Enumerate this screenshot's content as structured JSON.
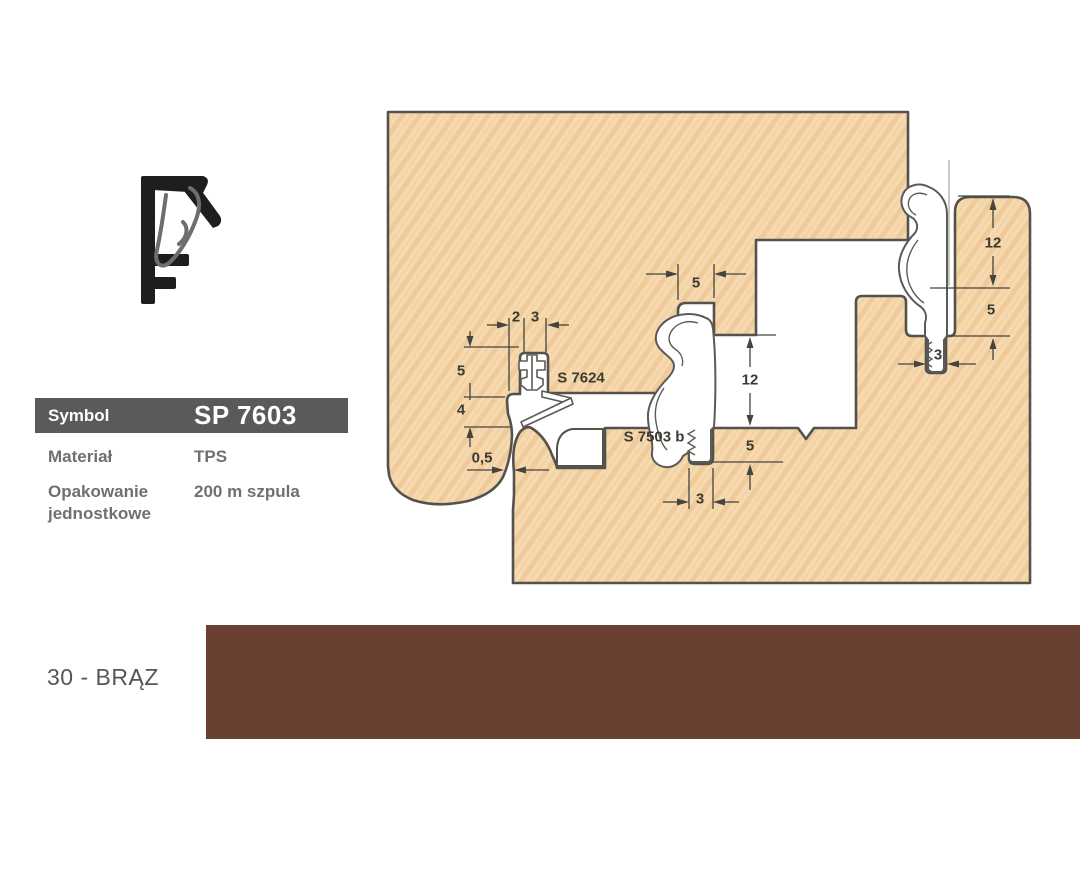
{
  "product": {
    "symbol_label": "Symbol",
    "symbol_value": "SP 7603",
    "material_label": "Materiał",
    "material_value": "TPS",
    "packaging_label_line1": "Opakowanie",
    "packaging_label_line2": "jednostkowe",
    "packaging_value": "200 m szpula"
  },
  "color_swatch": {
    "label": "30 - BRĄZ",
    "hex": "#694031"
  },
  "diagram": {
    "wood_fill": "#f6d9ae",
    "wood_grain": "#ecc493",
    "outline_color": "#53524c",
    "dimension_color": "#45443f",
    "labels": [
      {
        "id": "dim-2-left",
        "text": "2"
      },
      {
        "id": "dim-3-left",
        "text": "3"
      },
      {
        "id": "dim-5-left",
        "text": "5"
      },
      {
        "id": "dim-4-left",
        "text": "4"
      },
      {
        "id": "dim-05-left",
        "text": "0,5"
      },
      {
        "id": "ref-s7624",
        "text": "S 7624"
      },
      {
        "id": "dim-5-mid-top",
        "text": "5"
      },
      {
        "id": "dim-12-mid",
        "text": "12"
      },
      {
        "id": "dim-5-mid",
        "text": "5"
      },
      {
        "id": "dim-3-mid",
        "text": "3"
      },
      {
        "id": "ref-s7503b",
        "text": "S 7503 b"
      },
      {
        "id": "dim-12-right",
        "text": "12"
      },
      {
        "id": "dim-5-right",
        "text": "5"
      },
      {
        "id": "dim-3-right",
        "text": "3"
      }
    ]
  }
}
